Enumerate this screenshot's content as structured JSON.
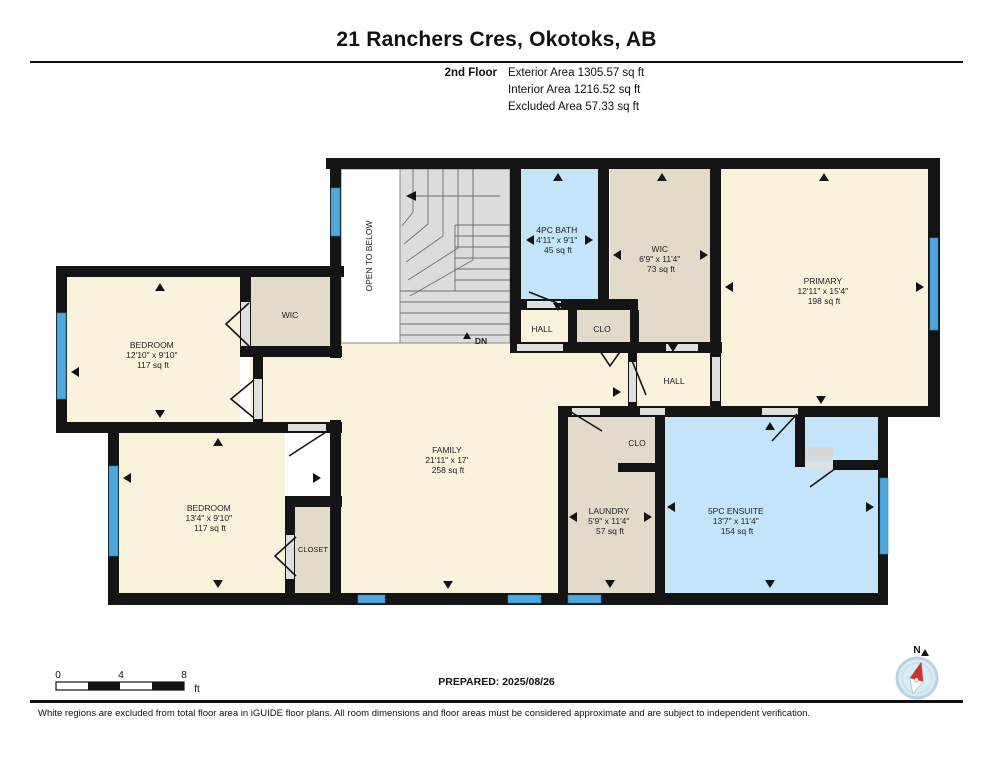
{
  "header": {
    "title": "21 Ranchers Cres, Okotoks, AB",
    "floor_label": "2nd Floor",
    "area_lines": [
      "Exterior Area 1305.57 sq ft",
      "Interior Area 1216.52 sq ft",
      "Excluded Area 57.33 sq ft"
    ]
  },
  "rooms": {
    "open_below": {
      "label": "OPEN TO BELOW"
    },
    "dn": {
      "label": "DN"
    },
    "bath": {
      "label": "4PC BATH",
      "dims": "4'11\" x 9'1\"",
      "area": "45 sq ft"
    },
    "wic": {
      "label": "WIC",
      "dims": "6'9\" x 11'4\"",
      "area": "73 sq ft"
    },
    "primary": {
      "label": "PRIMARY",
      "dims": "12'11\" x 15'4\"",
      "area": "198 sq ft"
    },
    "bedroom_top": {
      "label": "BEDROOM",
      "dims": "12'10\" x 9'10\"",
      "area": "117 sq ft"
    },
    "wic_left": {
      "label": "WIC"
    },
    "bedroom_bottom": {
      "label": "BEDROOM",
      "dims": "13'4\" x 9'10\"",
      "area": "117 sq ft"
    },
    "closet": {
      "label": "CLOSET"
    },
    "family": {
      "label": "FAMILY",
      "dims": "21'11\" x 17'",
      "area": "258 sq ft"
    },
    "hall_upper": {
      "label": "HALL"
    },
    "clo_upper": {
      "label": "CLO"
    },
    "hall_right": {
      "label": "HALL"
    },
    "clo_mid": {
      "label": "CLO"
    },
    "laundry": {
      "label": "LAUNDRY",
      "dims": "5'9\" x 11'4\"",
      "area": "57 sq ft"
    },
    "ensuite": {
      "label": "5PC ENSUITE",
      "dims": "13'7\" x 11'4\"",
      "area": "154 sq ft"
    }
  },
  "scale_bar": {
    "tick_0": "0",
    "tick_4": "4",
    "tick_8": "8",
    "unit": "ft"
  },
  "compass": {
    "north_label": "N"
  },
  "footer": {
    "prepared": "PREPARED: 2025/08/26",
    "disclaimer": "White regions are excluded from total floor area in iGUIDE floor plans. All room dimensions and floor areas must be considered approximate and are subject to independent verification."
  },
  "colors": {
    "room_cream": "#FAF3DB",
    "room_tan": "#E3DBCA",
    "room_blue": "#C4E4F9",
    "window_blue": "#4FA8DC",
    "stairs_grey": "#DCDCDC",
    "wall_black": "#141414"
  }
}
